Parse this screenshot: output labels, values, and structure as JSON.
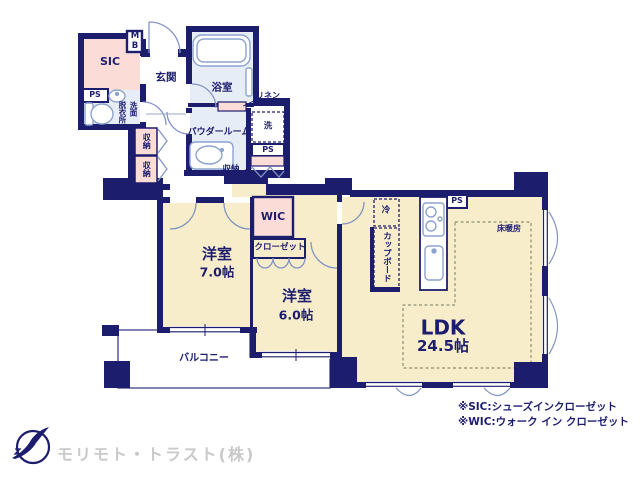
{
  "colors": {
    "wall_navy": "#1d1d6e",
    "room_cream": "#f8edcb",
    "closet_pink": "#fbdcd7",
    "wet_area_blue": "#e7edf7",
    "fixture_line": "#8da3cd",
    "logo_gray": "#c9c9c9"
  },
  "labels": {
    "sic": "SIC",
    "mb": "MB",
    "ps": "PS",
    "entrance": "玄関",
    "bathroom": "浴室",
    "linen": "リネン",
    "powder_room": "パウダールーム",
    "laundry": "洗",
    "storage": "収納",
    "dressing_room": "脱衣所",
    "washstand": "洗面",
    "wic": "WIC",
    "closet": "クローゼット",
    "refrigerator": "冷",
    "cupboard": "カップボード",
    "floor_heating": "床暖房",
    "balcony": "バルコニー"
  },
  "rooms": {
    "bedroom7": {
      "name": "洋室",
      "size": "7.0帖"
    },
    "bedroom6": {
      "name": "洋室",
      "size": "6.0帖"
    },
    "ldk": {
      "name": "LDK",
      "size": "24.5帖"
    }
  },
  "notes": {
    "sic": "※SIC:シューズインクローゼット",
    "wic": "※WIC:ウォーク イン クローゼット"
  },
  "footer": {
    "company": "モリモト・トラスト(株)"
  }
}
